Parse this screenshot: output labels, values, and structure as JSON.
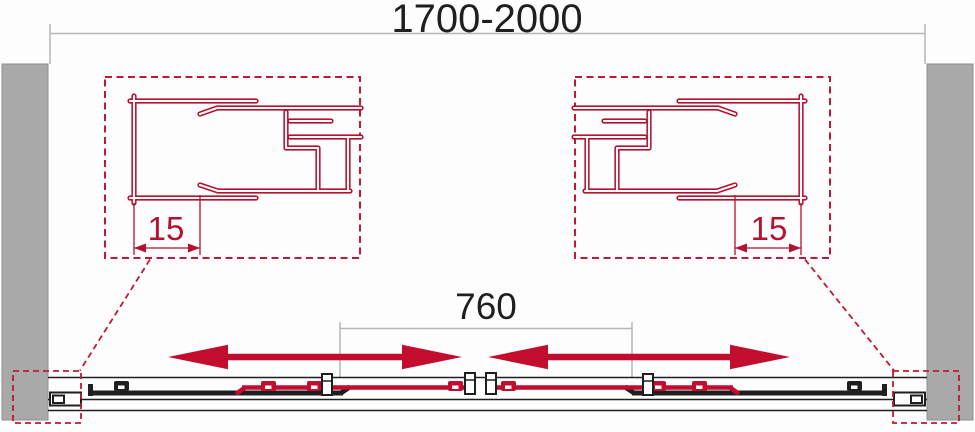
{
  "diagram": {
    "overall_width_label": "1700-2000",
    "opening_width_label": "760",
    "left_detail": {
      "adjustment_label": "15"
    },
    "right_detail": {
      "adjustment_label": "15"
    },
    "colors": {
      "profile_red": "#b51230",
      "arrow_red": "#c30d2e",
      "wall_gray": "#a9a9a9",
      "dim_line_gray": "#b6b6b6",
      "ink": "#1f1f1f"
    }
  }
}
